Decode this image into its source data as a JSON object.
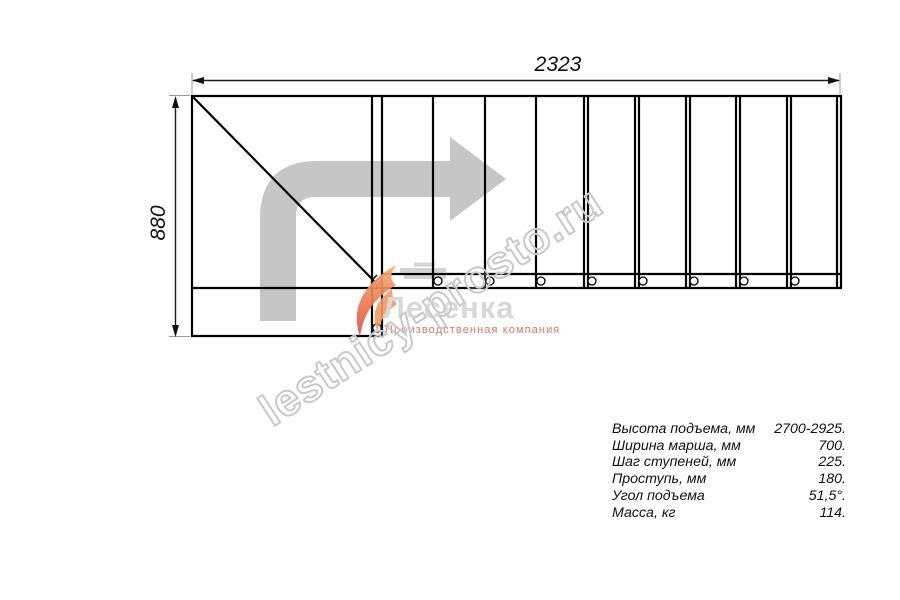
{
  "drawing": {
    "dim_width": "2323",
    "dim_height": "880",
    "arrow_color": "#c6c6c6"
  },
  "logo": {
    "name": "Лесенка",
    "tagline": "Производственная компания"
  },
  "watermark": {
    "text": "lestnicy-prosto.ru"
  },
  "specs": {
    "rows": [
      {
        "label": "Высота подъема, мм",
        "value": "2700-2925."
      },
      {
        "label": "Ширина марша, мм",
        "value": "700."
      },
      {
        "label": "Шаг ступеней, мм",
        "value": "225."
      },
      {
        "label": "Проступь, мм",
        "value": "180."
      },
      {
        "label": "Угол подъема",
        "value": "51,5°."
      },
      {
        "label": "Масса, кг",
        "value": "114."
      }
    ]
  }
}
